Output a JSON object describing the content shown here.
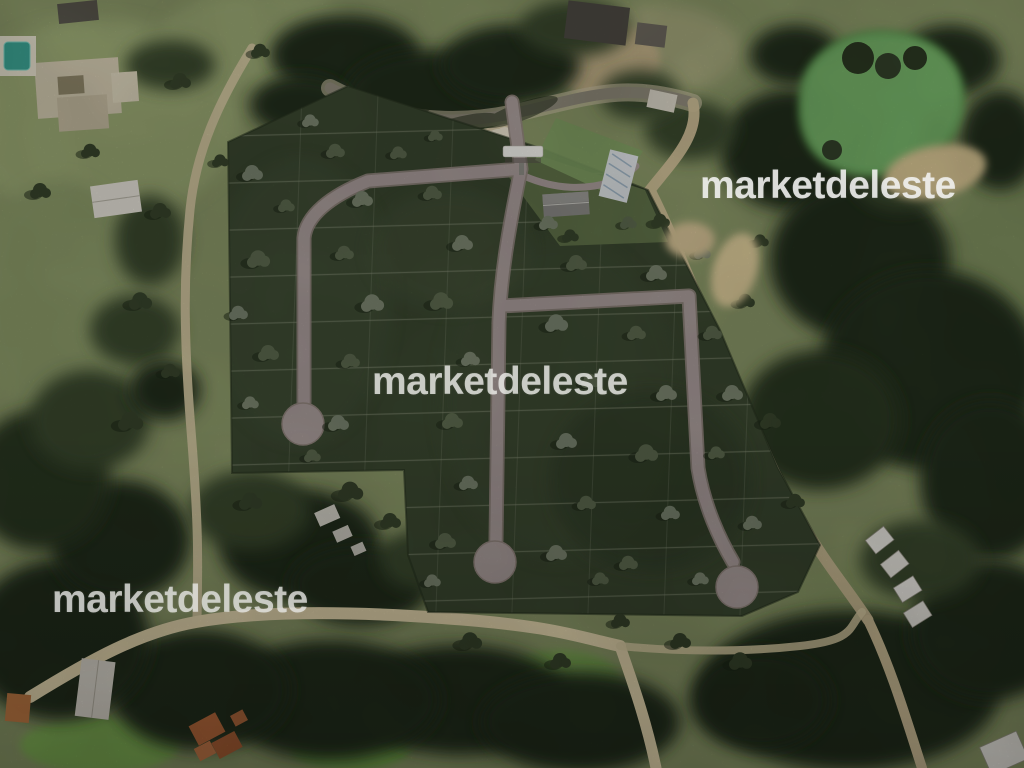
{
  "image": {
    "kind": "aerial-satellite-photo",
    "subject": "wooded land subdivision master plan with internal roads, three cul-de-sacs, gated entrance, pond and surrounding forest",
    "width_px": 1024,
    "height_px": 768
  },
  "watermark": {
    "text": "marketdeleste",
    "instances": [
      {
        "id": "top-right"
      },
      {
        "id": "center"
      },
      {
        "id": "bottom-left"
      }
    ]
  },
  "scene_features": [
    "subdivided lots overlay (dark green with light boundary lines)",
    "three cul-de-sac streets",
    "gated entrance with white canopy",
    "clubhouse buildings and green court near entrance",
    "green pond with sandy bank (top right)",
    "mansion with swimming pool (top left)",
    "white-roofed houses along dirt road (bottom right)",
    "terracotta-roofed house (bottom left)",
    "perimeter dirt roads and dense forest"
  ],
  "colors": {
    "field": "#8b9868",
    "field_light": "#9aa873",
    "forest": "#222e1b",
    "forest_mid": "#3a4a2e",
    "plot_green": "#3a4730",
    "plot_line": "#8a9279",
    "road_internal": "#ab9e9c",
    "road_edge": "#93867f",
    "dirt_road": "#d3c6a0",
    "dirt_road_bright": "#e4d6ae",
    "paved_road": "#8f8a7a",
    "pond": "#74b168",
    "sand": "#d5c291",
    "building_white": "#e8e6df",
    "roof_dark": "#4e4c46",
    "roof_terracotta": "#b5693c",
    "pool": "#3da393",
    "watermark": "#ecece9"
  }
}
